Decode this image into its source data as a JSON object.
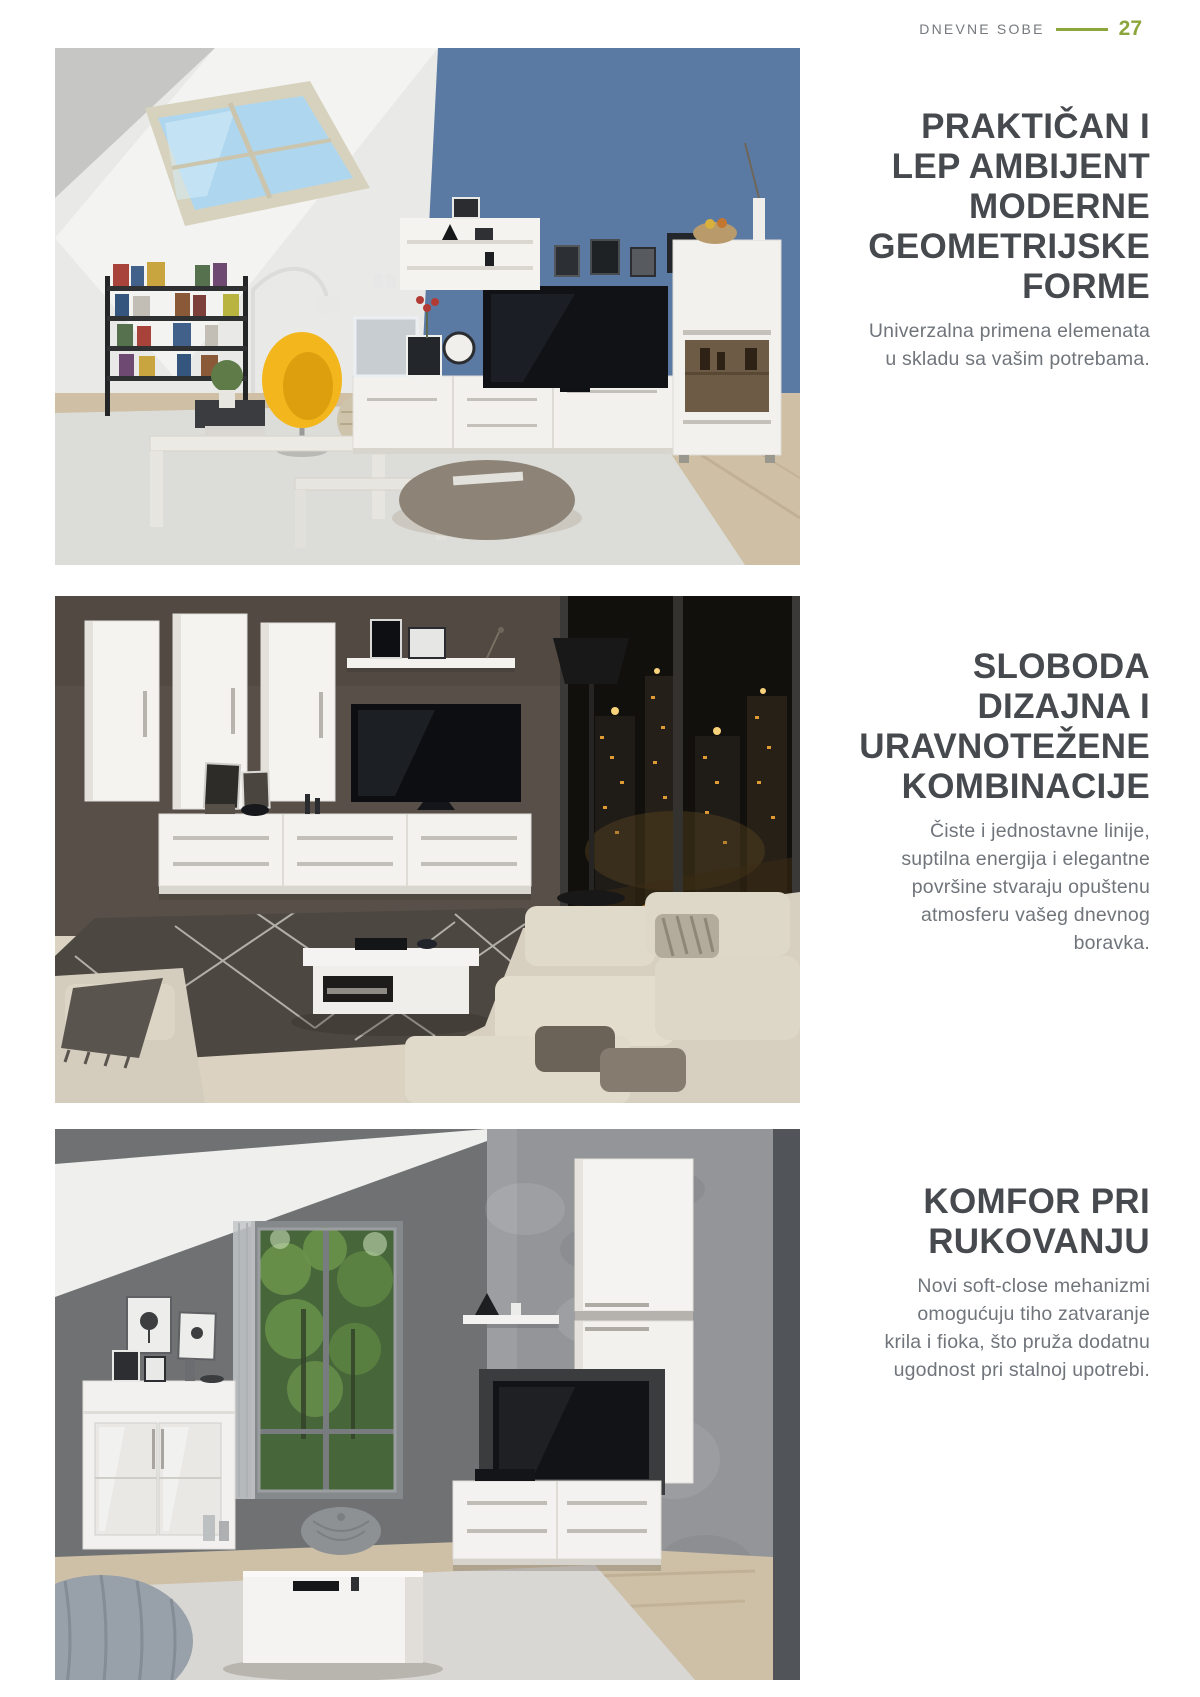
{
  "colors": {
    "accent_green": "#8CA63C",
    "heading_text": "#46494D",
    "body_text": "#70757B",
    "header_label": "#75797E"
  },
  "header": {
    "section_label": "DNEVNE SOBE",
    "page_number": "27"
  },
  "sections": [
    {
      "heading_lines": [
        "PRAKTIČAN I",
        "LEP AMBIJENT",
        "MODERNE",
        "GEOMETRIJSKE",
        "FORME"
      ],
      "body_lines": [
        "Univerzalna primena elemenata",
        "u skladu sa vašim potrebama."
      ],
      "image": {
        "alt": "Potkrovlje sa plavim zidom, krovnim prozorom, policama za knjige, žutom foteljom i belim TV elementima"
      }
    },
    {
      "heading_lines": [
        "SLOBODA",
        "DIZAJNA I",
        "URAVNOTEŽENE",
        "KOMBINACIJE"
      ],
      "body_lines": [
        "Čiste i jednostavne linije,",
        "suptilna energija i elegantne",
        "površine stvaraju opuštenu",
        "atmosferu vašeg dnevnog",
        "boravka."
      ],
      "image": {
        "alt": "Dnevna soba noću sa pogledom na grad, belim visećim elementima, televizorom i ugaonom garniturom"
      }
    },
    {
      "heading_lines": [
        "KOMFOR PRI",
        "RUKOVANJU"
      ],
      "body_lines": [
        "Novi soft-close mehanizmi",
        "omogućuju tiho zatvaranje",
        "krila i fioka, što pruža dodatnu",
        "ugodnost pri stalnoj upotrebi."
      ],
      "image": {
        "alt": "Dnevna soba sa sivim betonskim zidom, prozorom ka šumi, belom komodom i TV elementima"
      }
    }
  ]
}
